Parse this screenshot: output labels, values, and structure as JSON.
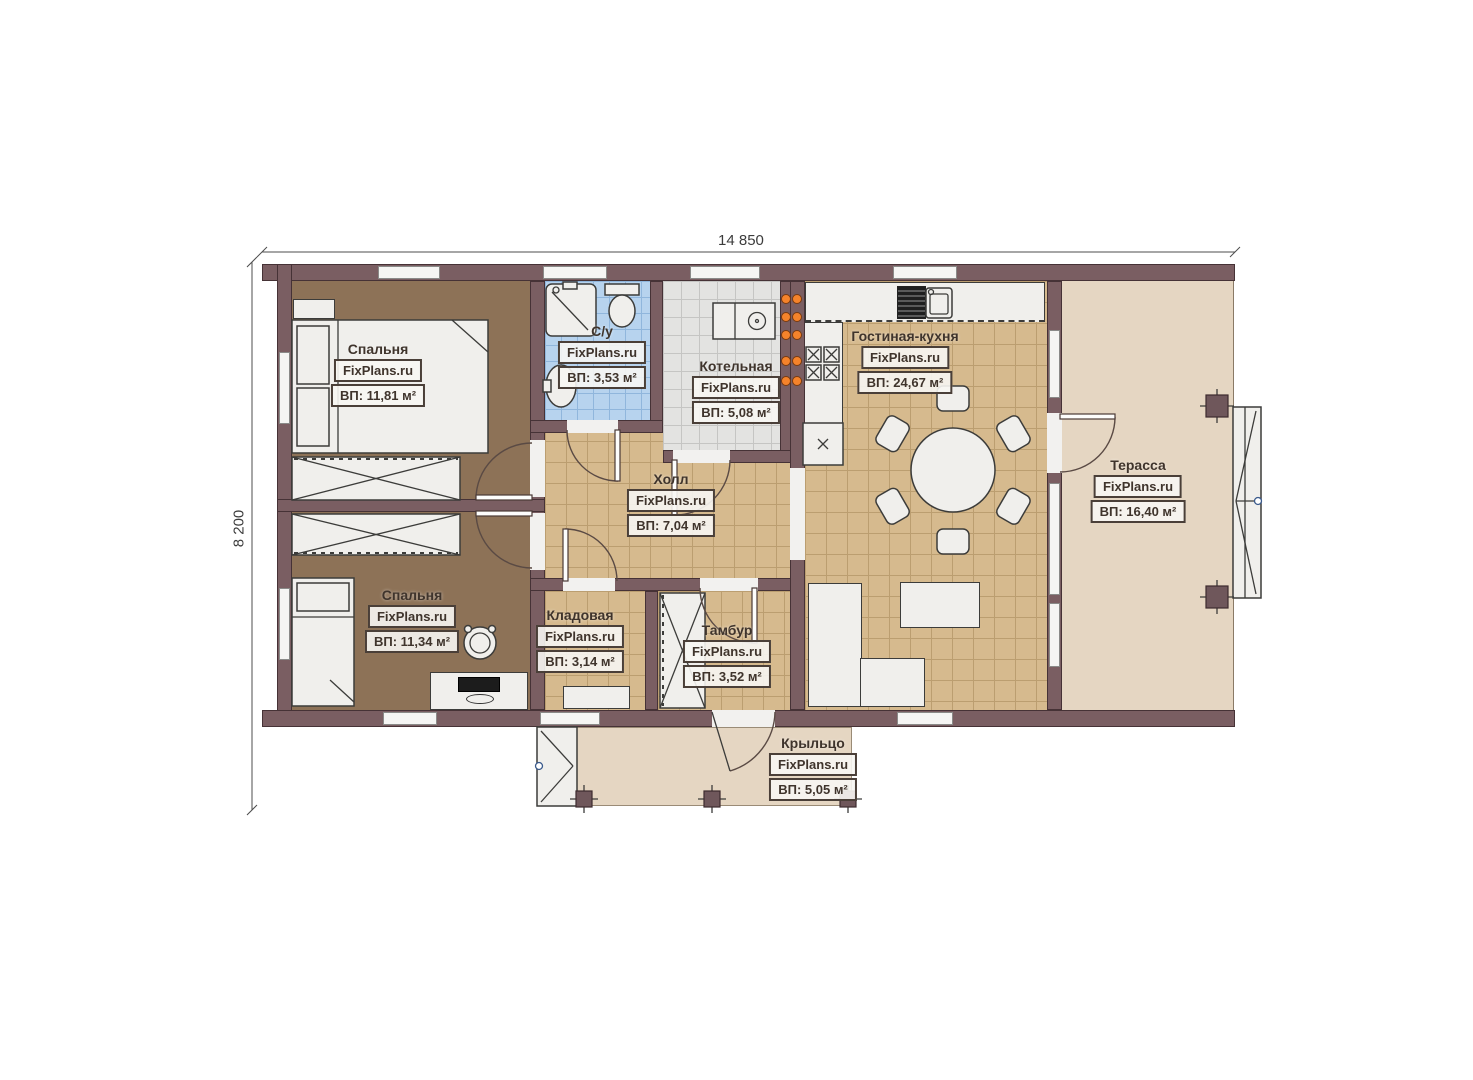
{
  "plan": {
    "width_dimension": "14 850",
    "height_dimension": "8 200"
  },
  "rooms": {
    "bedroom1": {
      "name": "Спальня",
      "watermark": "FixPlans.ru",
      "area": "ВП: 11,81 м²"
    },
    "bathroom": {
      "name": "С/у",
      "watermark": "FixPlans.ru",
      "area": "ВП: 3,53 м²"
    },
    "boiler": {
      "name": "Котельная",
      "watermark": "FixPlans.ru",
      "area": "ВП: 5,08 м²"
    },
    "hall": {
      "name": "Холл",
      "watermark": "FixPlans.ru",
      "area": "ВП: 7,04 м²"
    },
    "living_kitchen": {
      "name": "Гостиная-кухня",
      "watermark": "FixPlans.ru",
      "area": "ВП: 24,67 м²"
    },
    "terrace": {
      "name": "Терасса",
      "watermark": "FixPlans.ru",
      "area": "ВП: 16,40 м²"
    },
    "bedroom2": {
      "name": "Спальня",
      "watermark": "FixPlans.ru",
      "area": "ВП: 11,34 м²"
    },
    "storage": {
      "name": "Кладовая",
      "watermark": "FixPlans.ru",
      "area": "ВП: 3,14 м²"
    },
    "vestibule": {
      "name": "Тамбур",
      "watermark": "FixPlans.ru",
      "area": "ВП: 3,52 м²"
    },
    "porch": {
      "name": "Крыльцо",
      "watermark": "FixPlans.ru",
      "area": "ВП: 5,05 м²"
    }
  },
  "colors": {
    "wall": "#7a5e62",
    "wall_border": "#463236",
    "floor_bedroom": "#8d7257",
    "floor_tile_tan": "#d6ba8e",
    "floor_tile_tan_line": "#bb9e70",
    "floor_bath": "#b7d3ee",
    "floor_bath_line": "#90b6dc",
    "floor_boiler": "#e3e3e1",
    "floor_boiler_line": "#c5c5c3",
    "floor_terrace": "#e5d6c2",
    "furniture": "#f0efec",
    "accent_orange": "#f5832b",
    "label_text": "#3f342c"
  }
}
